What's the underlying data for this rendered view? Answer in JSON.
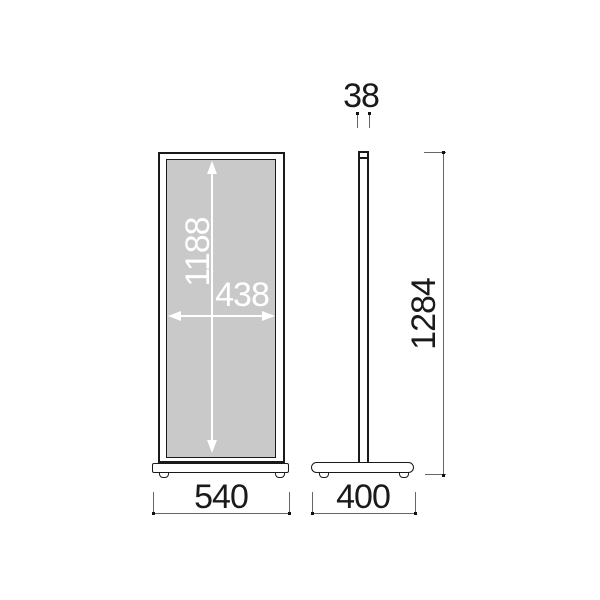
{
  "dims": {
    "pole_thickness": "38",
    "panel_inner_height": "1188",
    "panel_inner_width": "438",
    "overall_height": "1284",
    "front_base_width": "540",
    "side_base_depth": "400"
  },
  "colors": {
    "background": "#ffffff",
    "outline": "#1a1a1a",
    "panel_fill": "#c9c9c9",
    "dimension_line": "#666666",
    "dimension_dot": "#111111",
    "panel_arrow": "#ffffff"
  }
}
